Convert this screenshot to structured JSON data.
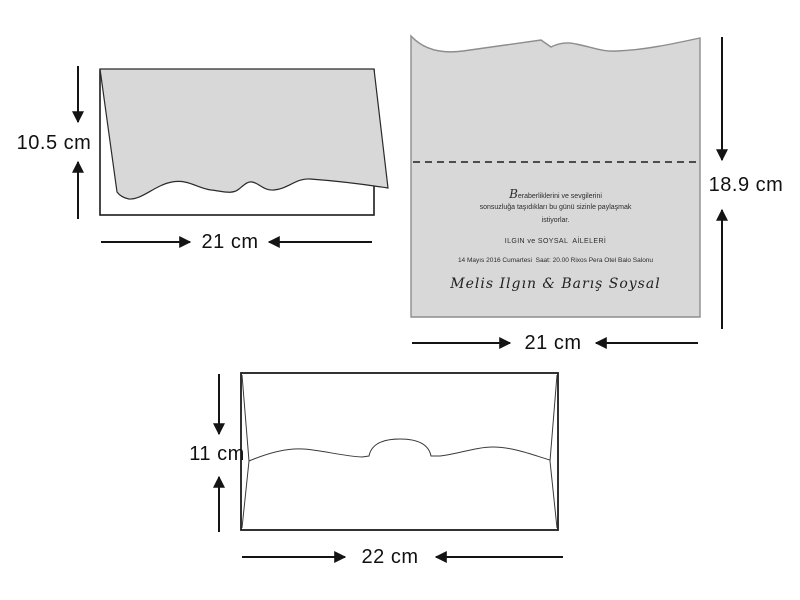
{
  "page": {
    "title": "Invitation card and envelope dimensions diagram"
  },
  "colors": {
    "background": "#ffffff",
    "card_fill": "#d8d8d8",
    "outline": "#1c1c1c"
  },
  "folded_card": {
    "height_label": "10.5 cm",
    "width_label": "21 cm"
  },
  "open_card": {
    "height_label": "18.9 cm",
    "width_label": "21 cm",
    "invitation": {
      "line1": "Beraberliklerini ve sevgilerini",
      "line2": "sonsuzluğa taşıdıkları bu günü sizinle paylaşmak",
      "line3": "istiyorlar.",
      "families": "ILGIN ve SOYSAL  AİLELERİ",
      "details": "14 Mayıs 2016 Cumartesi  Saat: 20.00 Rixos Pera Otel Balo Salonu",
      "names": "Melis Ilgın & Barış Soysal"
    }
  },
  "envelope": {
    "height_label": "11 cm",
    "width_label": "22 cm"
  }
}
